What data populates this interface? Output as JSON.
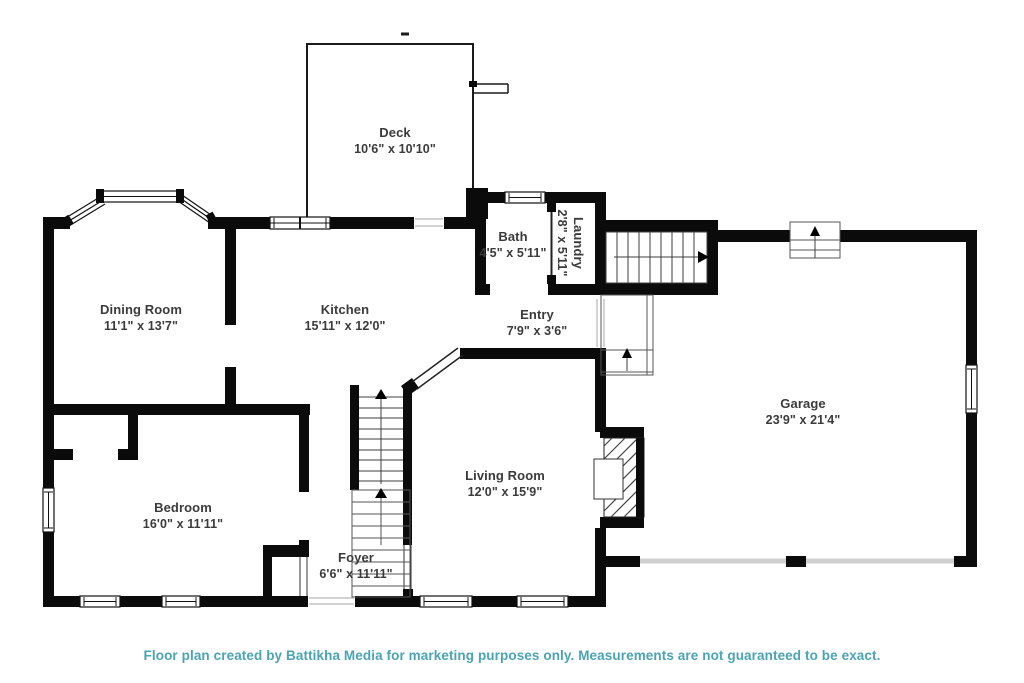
{
  "rooms": {
    "deck": {
      "name": "Deck",
      "dims": "10'6\" x 10'10\""
    },
    "dining_room": {
      "name": "Dining Room",
      "dims": "11'1\" x 13'7\""
    },
    "kitchen": {
      "name": "Kitchen",
      "dims": "15'11\" x 12'0\""
    },
    "bath": {
      "name": "Bath",
      "dims": "4'5\" x 5'11\""
    },
    "laundry": {
      "name": "Laundry",
      "dims": "2'8\" x 5'11\""
    },
    "entry": {
      "name": "Entry",
      "dims": "7'9\" x 3'6\""
    },
    "garage": {
      "name": "Garage",
      "dims": "23'9\" x 21'4\""
    },
    "bedroom": {
      "name": "Bedroom",
      "dims": "16'0\" x 11'11\""
    },
    "living_room": {
      "name": "Living Room",
      "dims": "12'0\" x 15'9\""
    },
    "foyer": {
      "name": "Foyer",
      "dims": "6'6\" x 11'11\""
    }
  },
  "footer": {
    "text": "Floor plan created by Battikha Media for marketing purposes only. Measurements are not guaranteed to be exact."
  },
  "colors": {
    "wall": "#0b0b0b",
    "label_text": "#3b3b3b",
    "footer_text": "#4aa4b6",
    "background": "#ffffff"
  }
}
